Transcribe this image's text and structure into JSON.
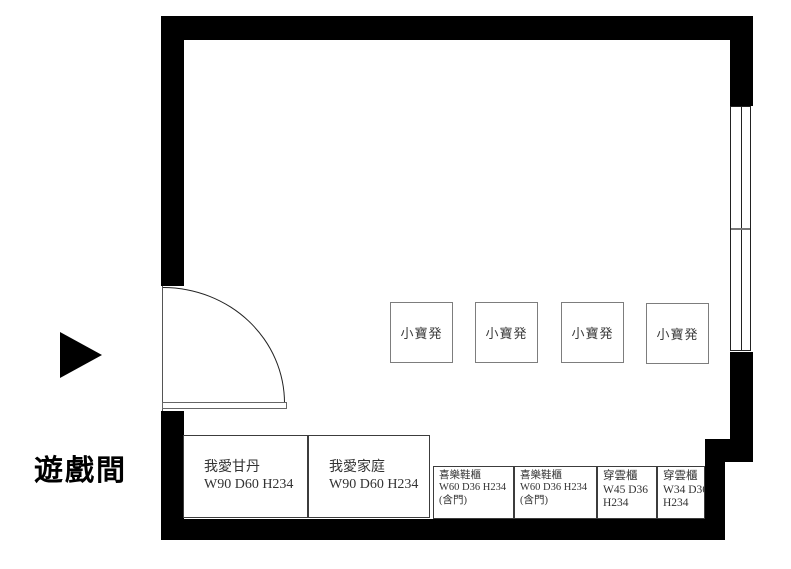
{
  "plan": {
    "room_name": "遊戲間",
    "stools": [
      {
        "label": "小寶発"
      },
      {
        "label": "小寶発"
      },
      {
        "label": "小寶発"
      },
      {
        "label": "小寶発"
      }
    ],
    "cabinets": [
      {
        "lines": [
          "我愛甘丹",
          "W90 D60 H234",
          ""
        ]
      },
      {
        "lines": [
          "我愛家庭",
          "W90 D60 H234",
          ""
        ]
      },
      {
        "lines": [
          "喜樂鞋櫃",
          "W60 D36 H234",
          "(含門)"
        ]
      },
      {
        "lines": [
          "喜樂鞋櫃",
          "W60 D36 H234",
          "(含門)"
        ]
      },
      {
        "lines": [
          "穿雲櫃",
          "W45 D36",
          "H234"
        ]
      },
      {
        "lines": [
          "穿雲櫃",
          "W34 D36",
          "H234"
        ]
      }
    ],
    "colors": {
      "wall": "#000000",
      "cabinet_border": "#3c3c3c",
      "stool_border": "#7d7d7d",
      "text": "#333333"
    }
  }
}
